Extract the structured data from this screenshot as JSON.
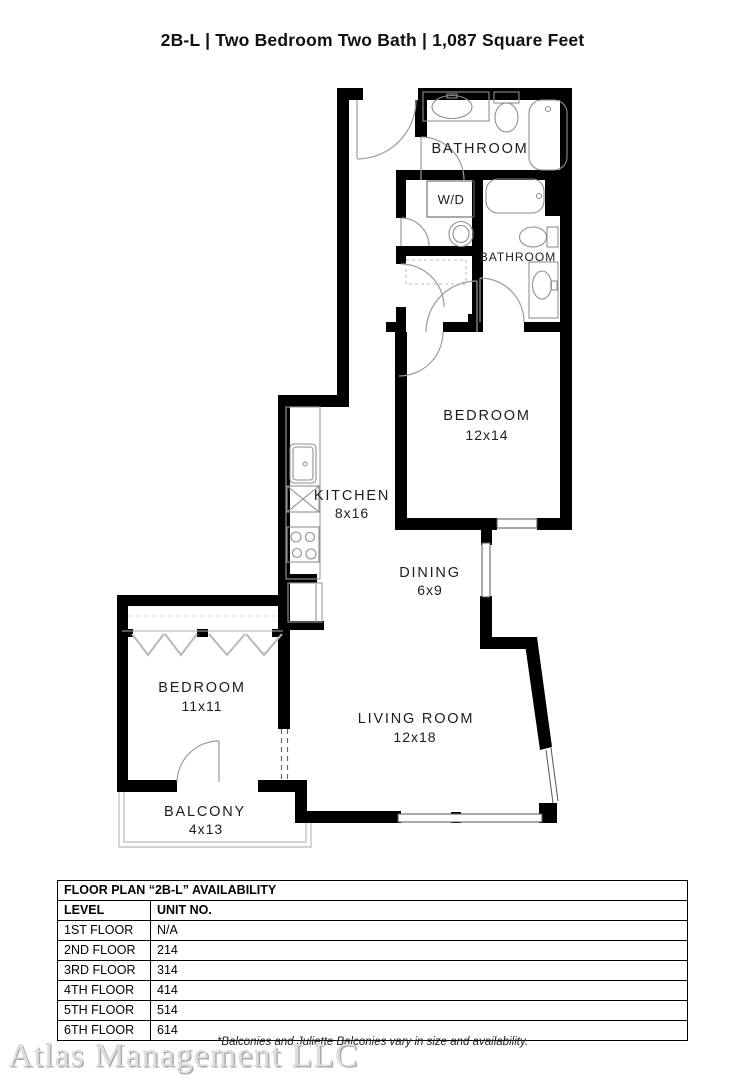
{
  "page": {
    "title": "2B-L | Two Bedroom Two Bath | 1,087  Square Feet"
  },
  "floor_plan": {
    "rooms": [
      {
        "id": "bathroom-upper",
        "label": "BATHROOM",
        "dims": ""
      },
      {
        "id": "washer-dryer",
        "label": "W/D",
        "dims": ""
      },
      {
        "id": "bathroom-lower",
        "label": "BATHROOM",
        "dims": ""
      },
      {
        "id": "bedroom-main",
        "label": "BEDROOM",
        "dims": "12x14"
      },
      {
        "id": "kitchen",
        "label": "KITCHEN",
        "dims": "8x16"
      },
      {
        "id": "dining",
        "label": "DINING",
        "dims": "6x9"
      },
      {
        "id": "bedroom-second",
        "label": "BEDROOM",
        "dims": "11x11"
      },
      {
        "id": "living-room",
        "label": "LIVING ROOM",
        "dims": "12x18"
      },
      {
        "id": "balcony",
        "label": "BALCONY",
        "dims": "4x13"
      }
    ]
  },
  "availability_table": {
    "title": "FLOOR PLAN “2B-L” AVAILABILITY",
    "columns": [
      "LEVEL",
      "UNIT NO."
    ],
    "rows": [
      {
        "level": "1ST FLOOR",
        "unit": "N/A"
      },
      {
        "level": "2ND FLOOR",
        "unit": "214"
      },
      {
        "level": "3RD FLOOR",
        "unit": "314"
      },
      {
        "level": "4TH FLOOR",
        "unit": "414"
      },
      {
        "level": "5TH FLOOR",
        "unit": "514"
      },
      {
        "level": "6TH FLOOR",
        "unit": "614"
      }
    ]
  },
  "footer": {
    "watermark": "Atlas Management LLC",
    "footnote": "*Balconies and Juliette Balconies vary in size and availability."
  },
  "colors": {
    "background": "#ffffff",
    "walls": "#000000",
    "fixtures": "#9a9a9a",
    "label_text": "#1d1d1d",
    "watermark": "#dddddd"
  }
}
